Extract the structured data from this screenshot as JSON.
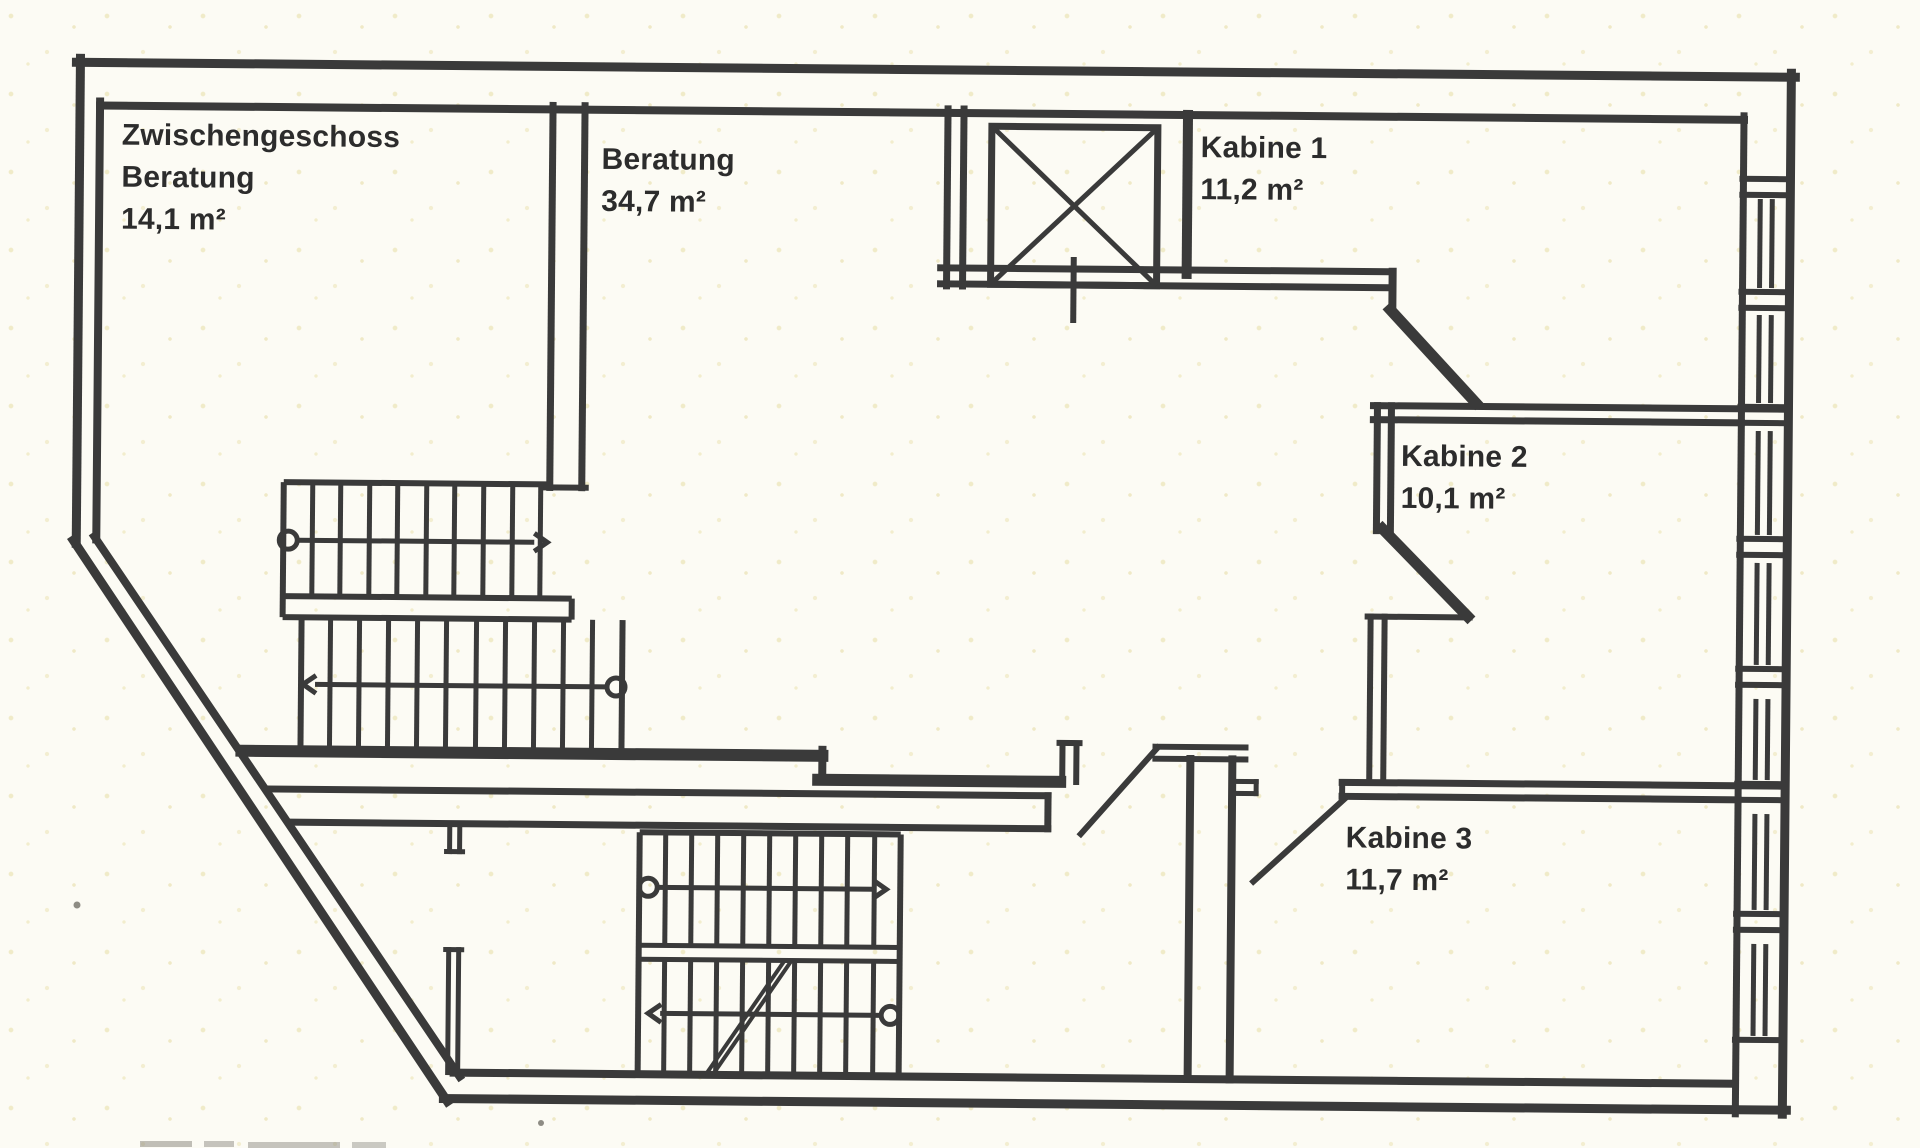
{
  "document": {
    "kind": "scanned-floor-plan",
    "floor_title": "Zwischengeschoss"
  },
  "rooms": [
    {
      "key": "zwischengeschoss-beratung",
      "label_lines": [
        "Zwischengeschoss",
        "Beratung",
        "14,1 m²"
      ],
      "area_m2": "14,1"
    },
    {
      "key": "beratung",
      "label_lines": [
        "Beratung",
        "34,7 m²"
      ],
      "area_m2": "34,7"
    },
    {
      "key": "kabine-1",
      "label_lines": [
        "Kabine 1",
        "11,2 m²"
      ],
      "area_m2": "11,2"
    },
    {
      "key": "kabine-2",
      "label_lines": [
        "Kabine 2",
        "10,1 m²"
      ],
      "area_m2": "10,1"
    },
    {
      "key": "kabine-3",
      "label_lines": [
        "Kabine 3",
        "11,7 m²"
      ],
      "area_m2": "11,7"
    }
  ],
  "symbols": {
    "elevator": "elevator-shaft-with-cross",
    "staircases": 2,
    "stair_direction_arrows": 4,
    "door_swings": 2,
    "window_band_side": "right"
  },
  "colors": {
    "ink": "#3a3a3a",
    "paper": "#fcfbf4",
    "speckle": "#f0ebc8",
    "text": "#2c2c2c"
  }
}
